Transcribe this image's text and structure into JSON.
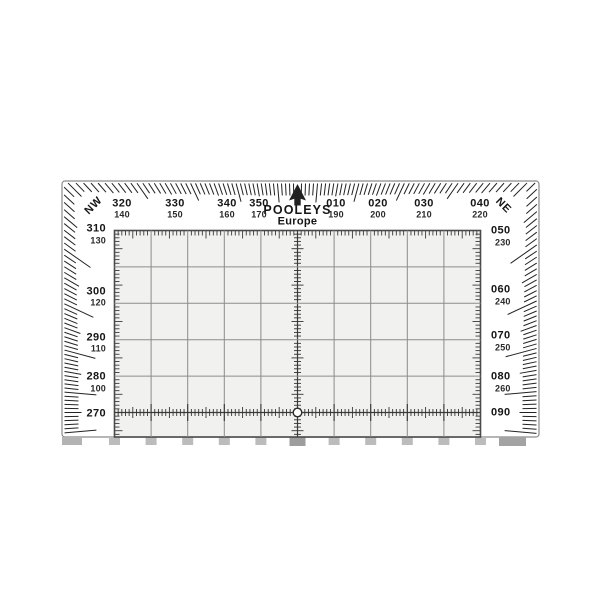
{
  "plotter": {
    "brand": "POOLEYS",
    "region": "Europe",
    "corner_labels": {
      "top_left": "NW",
      "top_right": "NE"
    },
    "top_scale": [
      {
        "main": "320",
        "recip": "140"
      },
      {
        "main": "330",
        "recip": "150"
      },
      {
        "main": "340",
        "recip": "160"
      },
      {
        "main": "350",
        "recip": "170"
      },
      {
        "main": "010",
        "recip": "190"
      },
      {
        "main": "020",
        "recip": "200"
      },
      {
        "main": "030",
        "recip": "210"
      },
      {
        "main": "040",
        "recip": "220"
      }
    ],
    "left_scale": [
      {
        "main": "310",
        "recip": "130"
      },
      {
        "main": "300",
        "recip": "120"
      },
      {
        "main": "290",
        "recip": "110"
      },
      {
        "main": "280",
        "recip": "100"
      },
      {
        "main": "270",
        "recip": ""
      }
    ],
    "right_scale": [
      {
        "main": "050",
        "recip": "230"
      },
      {
        "main": "060",
        "recip": "240"
      },
      {
        "main": "070",
        "recip": "250"
      },
      {
        "main": "080",
        "recip": "260"
      },
      {
        "main": "090",
        "recip": ""
      }
    ],
    "colors": {
      "ink": "#222222",
      "grid_line": "#8c8c8c",
      "grid_border": "#4a4a4a",
      "grid_bg": "#f1f1ef",
      "body": "#ffffff",
      "outline": "#8a8a8a",
      "tab": "#bcbcbc",
      "tab_dark": "#9d9d9d"
    }
  }
}
